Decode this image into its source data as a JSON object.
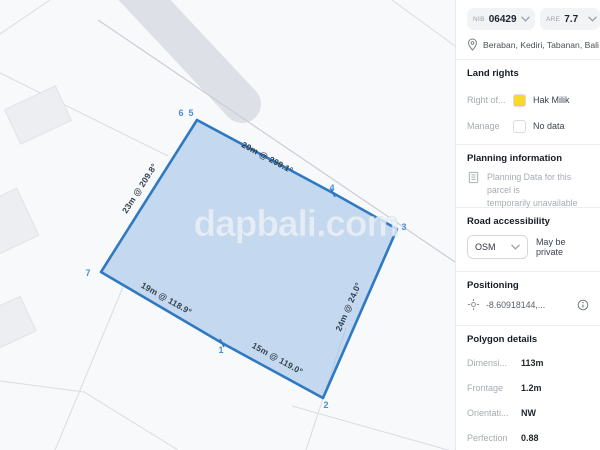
{
  "map": {
    "watermark": "dapbali.com",
    "edge_labels": [
      {
        "text": "20m @ 299.1°"
      },
      {
        "text": "23m @ 209.8°"
      },
      {
        "text": "19m @ 118.9°"
      },
      {
        "text": "15m @ 119.0°"
      },
      {
        "text": "24m @ 24.0°"
      }
    ],
    "vertex_labels": [
      {
        "text": "6"
      },
      {
        "text": "5"
      },
      {
        "text": "4"
      },
      {
        "text": "3"
      },
      {
        "text": "2"
      },
      {
        "text": "1"
      },
      {
        "text": "7"
      }
    ],
    "colors": {
      "parcel_stroke": "#2E79C2",
      "parcel_fill": "#8FB9E3",
      "vertex_label": "#4A90D2",
      "edge_label": "#33404E",
      "watermark_fill": "#EDF2F9"
    }
  },
  "sidebar": {
    "parcel_header": {
      "nib_label": "NIB",
      "nib_value": "06429",
      "are_label": "Are",
      "are_value": "7.7",
      "location": "Beraban, Kediri, Tabanan, Bali"
    },
    "land_rights": {
      "title": "Land rights",
      "rows": [
        {
          "label": "Right of...",
          "value": "Hak Milik",
          "swatch_color": "#F8D829"
        },
        {
          "label": "Manage",
          "value": "No data",
          "swatch_color": "#FFFFFF"
        }
      ]
    },
    "planning": {
      "title": "Planning information",
      "message_line1": "Planning Data for this parcel is",
      "message_line2": "temporarily unavailable"
    },
    "road": {
      "title": "Road accessibility",
      "source": "OSM",
      "note": "May be private"
    },
    "positioning": {
      "title": "Positioning",
      "coordinates": "-8.60918144,..."
    },
    "polygon_details": {
      "title": "Polygon details",
      "rows": [
        {
          "label": "Dimensi...",
          "value": "113m"
        },
        {
          "label": "Frontage",
          "value": "1.2m"
        },
        {
          "label": "Orientati...",
          "value": "NW"
        },
        {
          "label": "Perfection",
          "value": "0.88"
        }
      ]
    }
  }
}
